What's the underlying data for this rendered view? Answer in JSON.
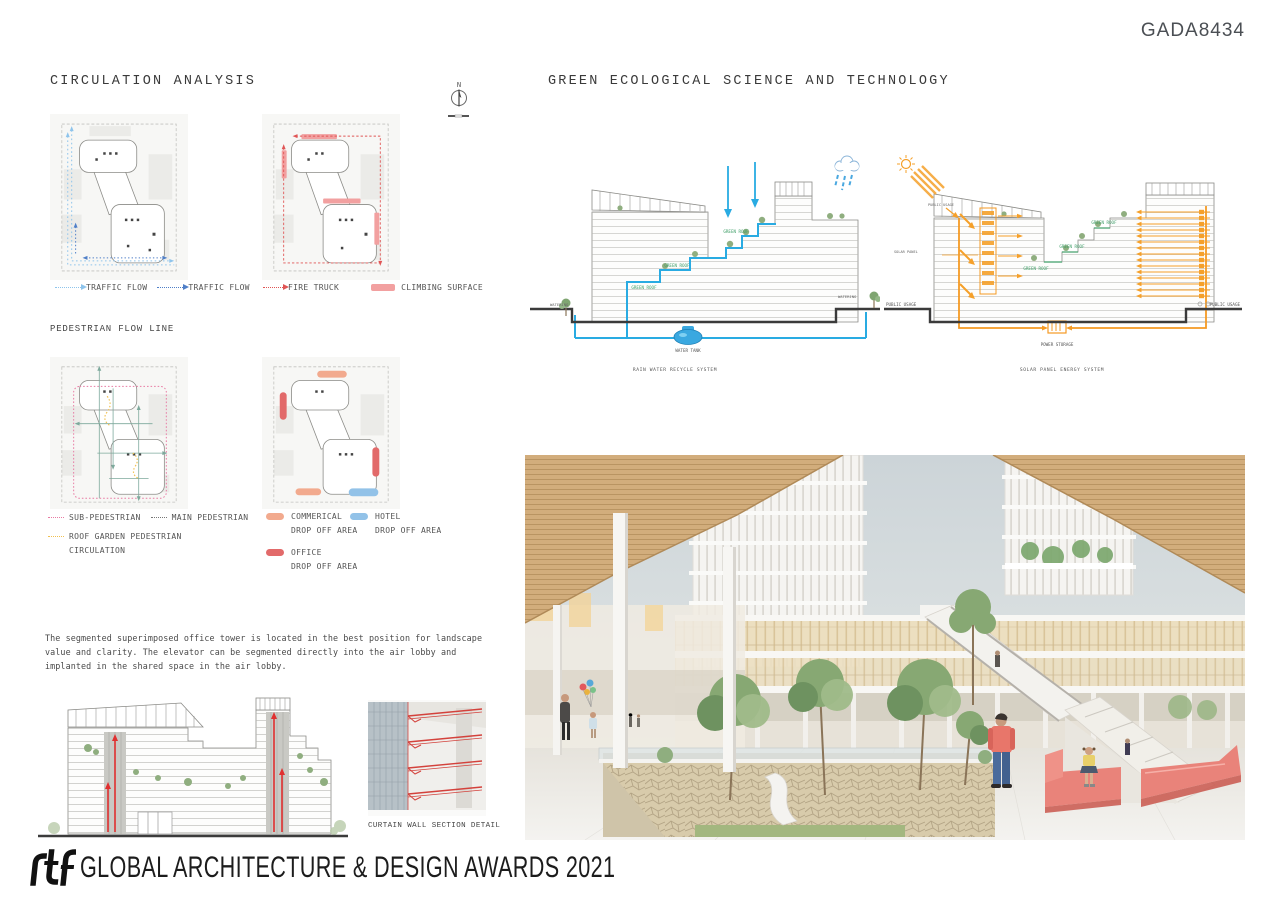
{
  "header": {
    "code": "GADA8434"
  },
  "circulation": {
    "title": "CIRCULATION ANALYSIS",
    "compass": "N",
    "legend_row1_left": [
      {
        "label": "TRAFFIC FLOW",
        "color": "#8ec4ec"
      },
      {
        "label": "TRAFFIC FLOW",
        "color": "#4f7fc8"
      }
    ],
    "legend_row1_right": [
      {
        "label": "FIRE TRUCK",
        "color": "#e05555"
      },
      {
        "label": "CLIMBING SURFACE",
        "color": "#f2a0a0"
      }
    ],
    "pedestrian_title": "PEDESTRIAN FLOW LINE",
    "legend_row2": [
      {
        "label": "SUB-PEDESTRIAN",
        "color": "#e87ba3"
      },
      {
        "label": "MAIN PEDESTRIAN",
        "color": "#777777"
      },
      {
        "label": "ROOF GARDEN PEDESTRIAN",
        "color": "#f0c050"
      },
      {
        "label": "CIRCULATION"
      }
    ],
    "dropoff_legend": [
      {
        "name": "COMMERICAL",
        "area": "DROP OFF AREA",
        "color": "#f2aa8e"
      },
      {
        "name": "HOTEL",
        "area": "DROP OFF AREA",
        "color": "#92c2e8"
      },
      {
        "name": "OFFICE",
        "area": "DROP OFF AREA",
        "color": "#e26a6a"
      }
    ],
    "description": "The segmented superimposed office tower is located in the best position for landscape value and clarity. The elevator can be segmented directly into the air lobby and implanted in the shared space in the air lobby."
  },
  "green_tech": {
    "title": "GREEN ECOLOGICAL SCIENCE AND TECHNOLOGY",
    "rain": {
      "caption": "RAIN WATER RECYCLE SYSTEM",
      "water_tank": "WATER TANK",
      "watering": "WATERING",
      "green_roof": "GREEN ROOF",
      "accent_color": "#29abe2"
    },
    "solar": {
      "caption": "SOLAR PANEL ENERGY SYSTEM",
      "power_storage": "POWER STORAGE",
      "public_usage": "PUBLIC USAGE",
      "solar_panel": "SOLAR PANEL",
      "green_roof": "GREEN ROOF",
      "accent_color": "#f5a02a"
    }
  },
  "curtain_wall": {
    "caption": "CURTAIN WALL SECTION DETAIL"
  },
  "footer": {
    "logo": "rtf",
    "title": "GLOBAL ARCHITECTURE & DESIGN AWARDS 2021"
  }
}
